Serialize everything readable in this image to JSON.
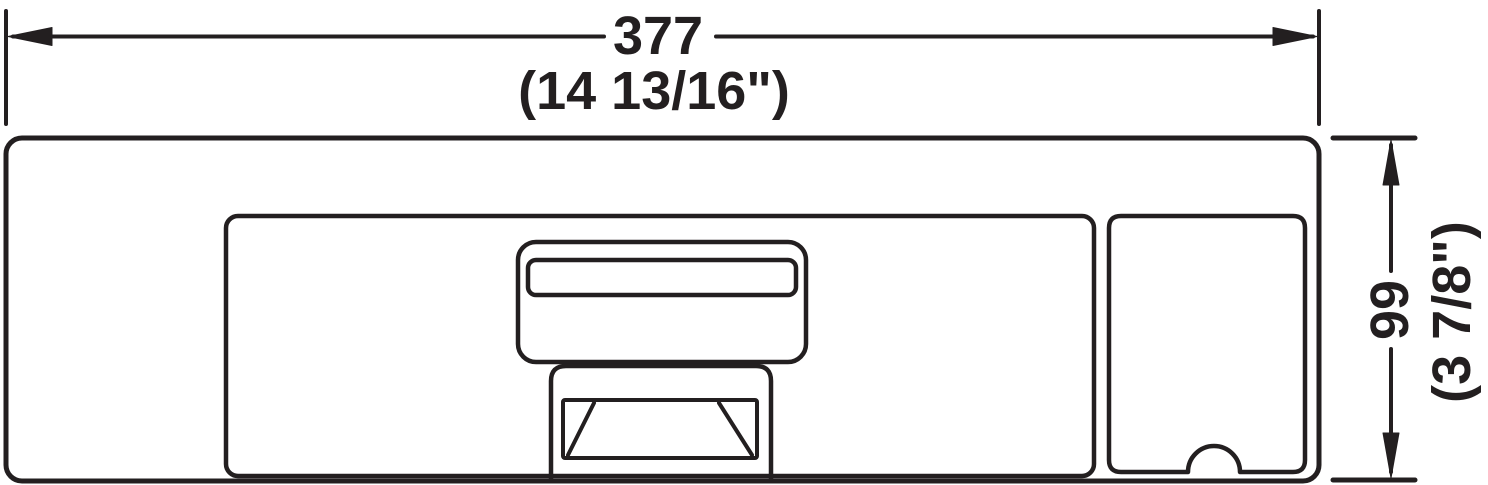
{
  "drawing": {
    "type": "technical-dimension-drawing",
    "background_color": "#ffffff",
    "line_color": "#231f20",
    "width_dimension": {
      "metric": "377",
      "imperial": "(14 13/16\")"
    },
    "height_dimension": {
      "metric": "99",
      "imperial": "(3 7/8\")"
    }
  }
}
